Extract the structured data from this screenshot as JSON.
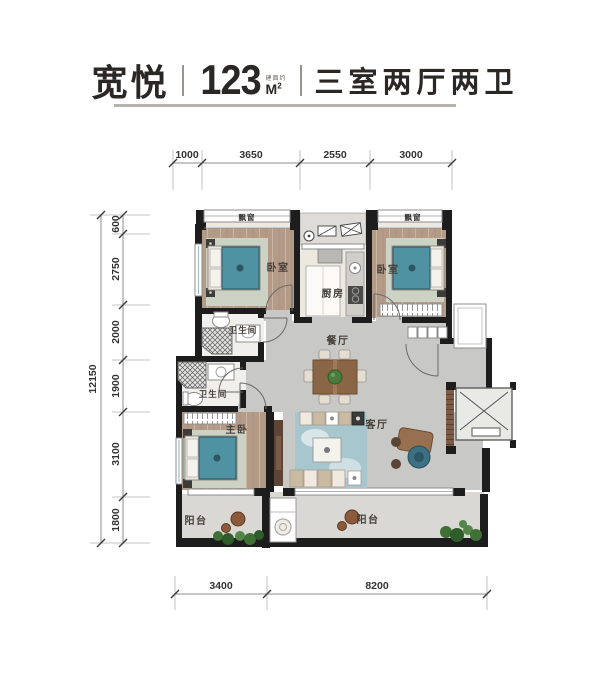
{
  "header": {
    "project_name": "宽悦",
    "area_value": "123",
    "area_prefix": "建面约",
    "area_unit_letter": "M",
    "area_unit_sup": "2",
    "layout_text": "三室两厅两卫"
  },
  "dimensions": {
    "top": [
      "1000",
      "3650",
      "2550",
      "3000"
    ],
    "left_total": "12150",
    "left": [
      "600",
      "2750",
      "2000",
      "1900",
      "3100",
      "1800"
    ],
    "bottom": [
      "3400",
      "8200"
    ]
  },
  "rooms": {
    "bay_left": "飘窗",
    "bay_right": "飘窗",
    "bedroom_left": "卧室",
    "bedroom_right": "卧室",
    "kitchen": "厨房",
    "bath_upper": "卫生间",
    "bath_lower": "卫生间",
    "dining": "餐厅",
    "living": "客厅",
    "master": "主卧",
    "balcony_left": "阳台",
    "balcony_right": "阳台"
  },
  "colors": {
    "wall": "#1d1d1d",
    "wood_floor": "#b49b87",
    "gray_floor": "#c8c8c6",
    "balcony_floor": "#d9d8d4",
    "bed_teal": "#4f93a2",
    "plant_green": "#4a7c3f",
    "title_text": "#2b2724"
  }
}
